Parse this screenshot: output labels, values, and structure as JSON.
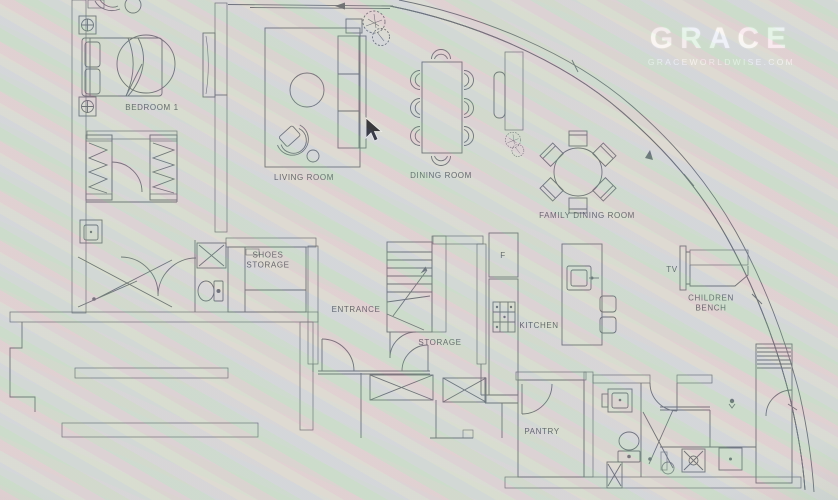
{
  "watermark": {
    "brand": "GRACE",
    "site": "GRACEWORLDWISE.COM"
  },
  "rooms": {
    "bedroom1": "BEDROOM 1",
    "living": "LIVING ROOM",
    "dining": "DINING ROOM",
    "family_dining": "FAMILY DINING ROOM",
    "shoes_line1": "SHOES",
    "shoes_line2": "STORAGE",
    "entrance": "ENTRANCE",
    "storage": "STORAGE",
    "kitchen": "KITCHEN",
    "pantry": "PANTRY",
    "children_line1": "CHILDREN",
    "children_line2": "BENCH",
    "tv": "TV",
    "fridge": "F"
  },
  "colors": {
    "paper": "#d8d9d2",
    "ink": "#565b61",
    "wall_dark": "#43484e",
    "watermark": "rgba(255,255,255,0.8)"
  }
}
